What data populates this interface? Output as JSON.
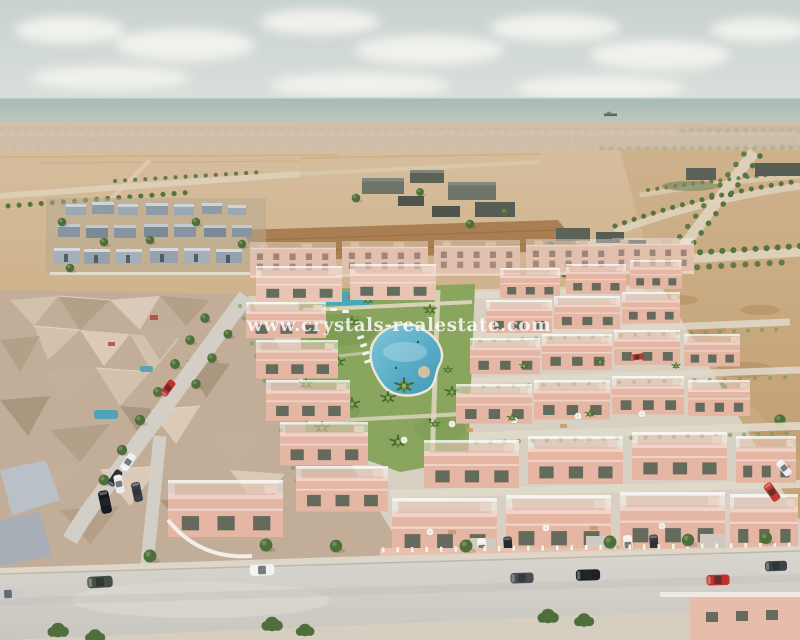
{
  "watermark": {
    "text": "www.crystals-realestate.com"
  },
  "scene": {
    "subject": "aerial-3d-render-coastal-residential-development",
    "landmarks": {
      "sea": "sea-horizon",
      "ship": "cargo-ship",
      "pool": "lagoon-swimming-pool",
      "development": "pink-villa-complex",
      "old_town": "existing-beige-houses",
      "main_road": "foreground-street-with-parked-cars"
    }
  },
  "colors": {
    "sky_top": "#c8d2d0",
    "sky_bottom": "#e0e4df",
    "cloud": "#f0f1ec",
    "sea_top": "#a7bab3",
    "sea_bottom": "#bfcac2",
    "town_strip": "#c9b59d",
    "sand_light": "#d6bd9c",
    "sand_dark": "#c2a071",
    "dirt_field": "#a87e52",
    "road_light": "#d8d5cf",
    "road_dark": "#c9c6bf",
    "sidewalk": "#ddd6c9",
    "grass": "#8aa55e",
    "lawn": "#7a9a50",
    "pool_light": "#7cc6d8",
    "pool_dark": "#3f98b8",
    "play_pool": "#49a8b8",
    "villa_pink": "#e5b6a4",
    "villa_light": "#e9c4b2",
    "apartment_pink": "#e2c0ae",
    "window_green": "#44584a",
    "tree": "#4e7037",
    "palm": "#5d8a3f",
    "bush": "#4e6f3c",
    "old_town_beige": "#c2ae98",
    "white_building": "#9fabb5",
    "dark_building": "#63685f",
    "car_white": "#f2f2f0",
    "car_black": "#1d2024",
    "car_green": "#434f45",
    "car_red": "#c0332b",
    "car_gray": "#4a4e52",
    "car_silver": "#c9cdd0",
    "watermark_color": "#ffffff"
  }
}
